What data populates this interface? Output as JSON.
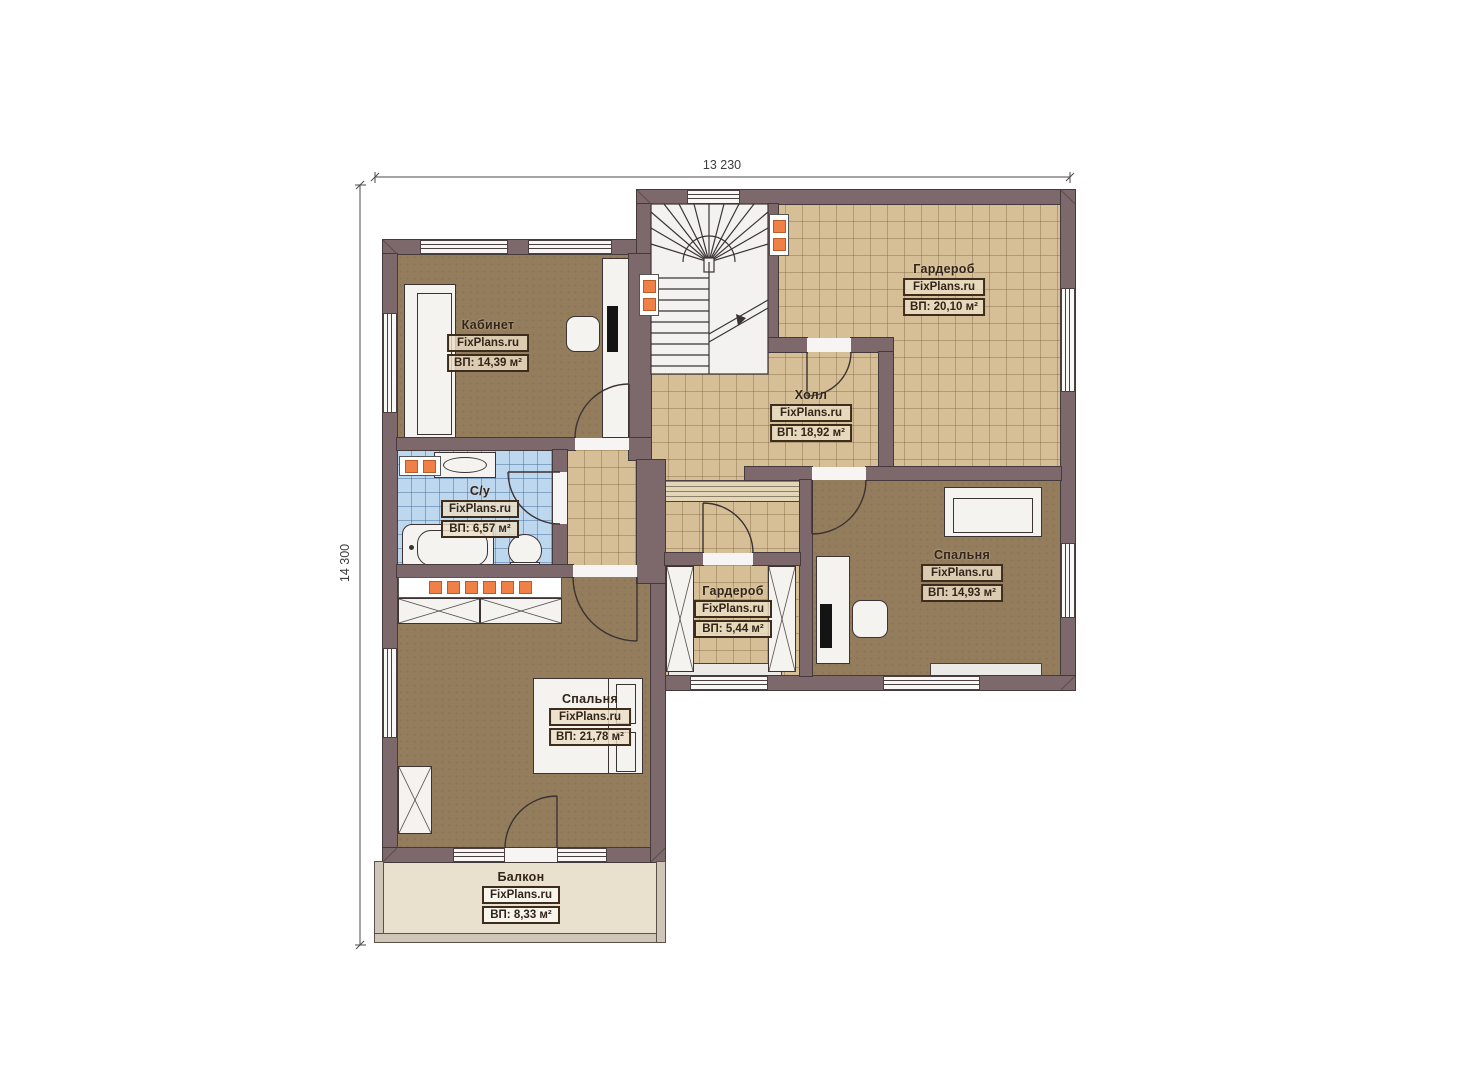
{
  "meta": {
    "type": "floor-plan",
    "floor": "2"
  },
  "dimensions": {
    "width_label": "13 230",
    "height_label": "14 300"
  },
  "watermark": "FixPlans.ru",
  "rooms": [
    {
      "name": "Кабинет",
      "area": "ВП: 14,39 м²"
    },
    {
      "name": "Гардероб",
      "area": "ВП: 20,10 м²"
    },
    {
      "name": "Холл",
      "area": "ВП: 18,92 м²"
    },
    {
      "name": "С/у",
      "area": "ВП: 6,57 м²"
    },
    {
      "name": "Гардероб",
      "area": "ВП: 5,44 м²"
    },
    {
      "name": "Спальня",
      "area": "ВП: 14,93 м²"
    },
    {
      "name": "Спальня",
      "area": "ВП: 21,78 м²"
    },
    {
      "name": "Балкон",
      "area": "ВП: 8,33 м²"
    }
  ],
  "colors": {
    "wall": "#7d696c",
    "outline": "#3c3335",
    "floor_room": "#947d5c",
    "floor_tile": "#d6bf96",
    "floor_bath": "#bdd7ee",
    "floor_balcony": "#e9e1ce",
    "radiator": "#ef8046"
  }
}
